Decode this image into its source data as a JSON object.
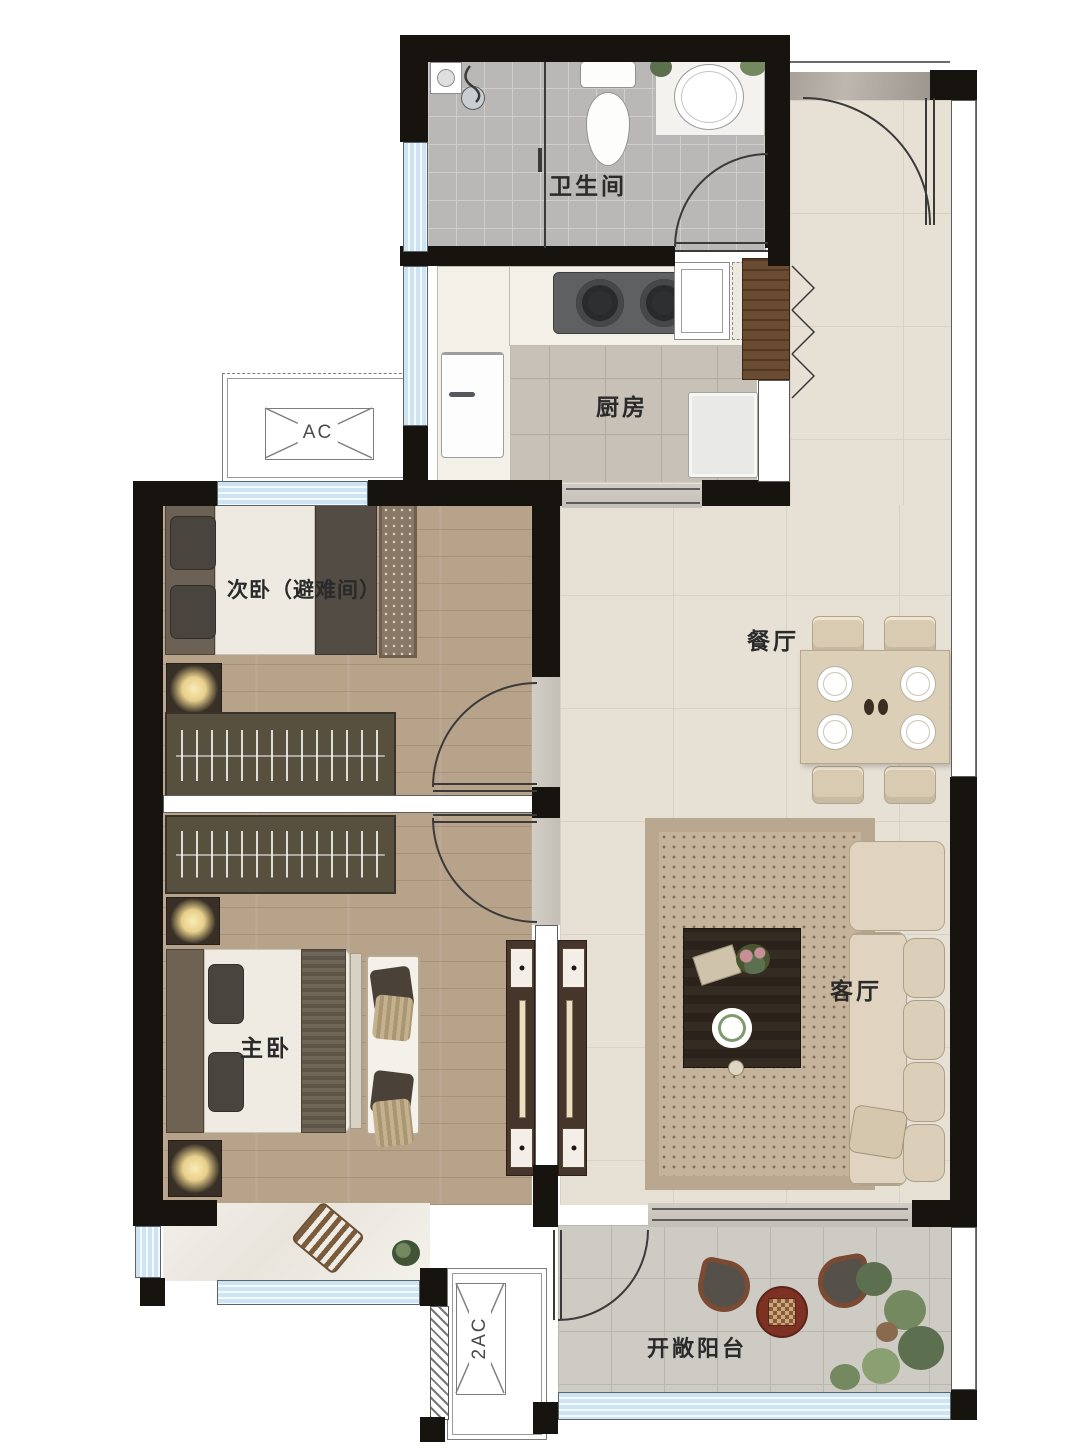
{
  "floorplan": {
    "rooms": {
      "bathroom": {
        "label": "卫生间"
      },
      "kitchen": {
        "label": "厨房"
      },
      "secondary_bedroom": {
        "label": "次卧（避难间）"
      },
      "dining_room": {
        "label": "餐厅"
      },
      "living_room": {
        "label": "客厅"
      },
      "master_bedroom": {
        "label": "主卧"
      },
      "balcony": {
        "label": "开敞阳台"
      }
    },
    "ac_platforms": {
      "upper": {
        "label": "AC"
      },
      "lower": {
        "label": "2AC"
      }
    },
    "colors": {
      "wall": "#17140f",
      "window_blue": "#cfe4f2",
      "living_tile": "#e6e0d5",
      "wood_floor": "#b7a28a",
      "bathroom_tile": "#b9b8b6",
      "balcony_tile": "#cecbc5",
      "balcony_table_red": "#7c3122"
    }
  }
}
